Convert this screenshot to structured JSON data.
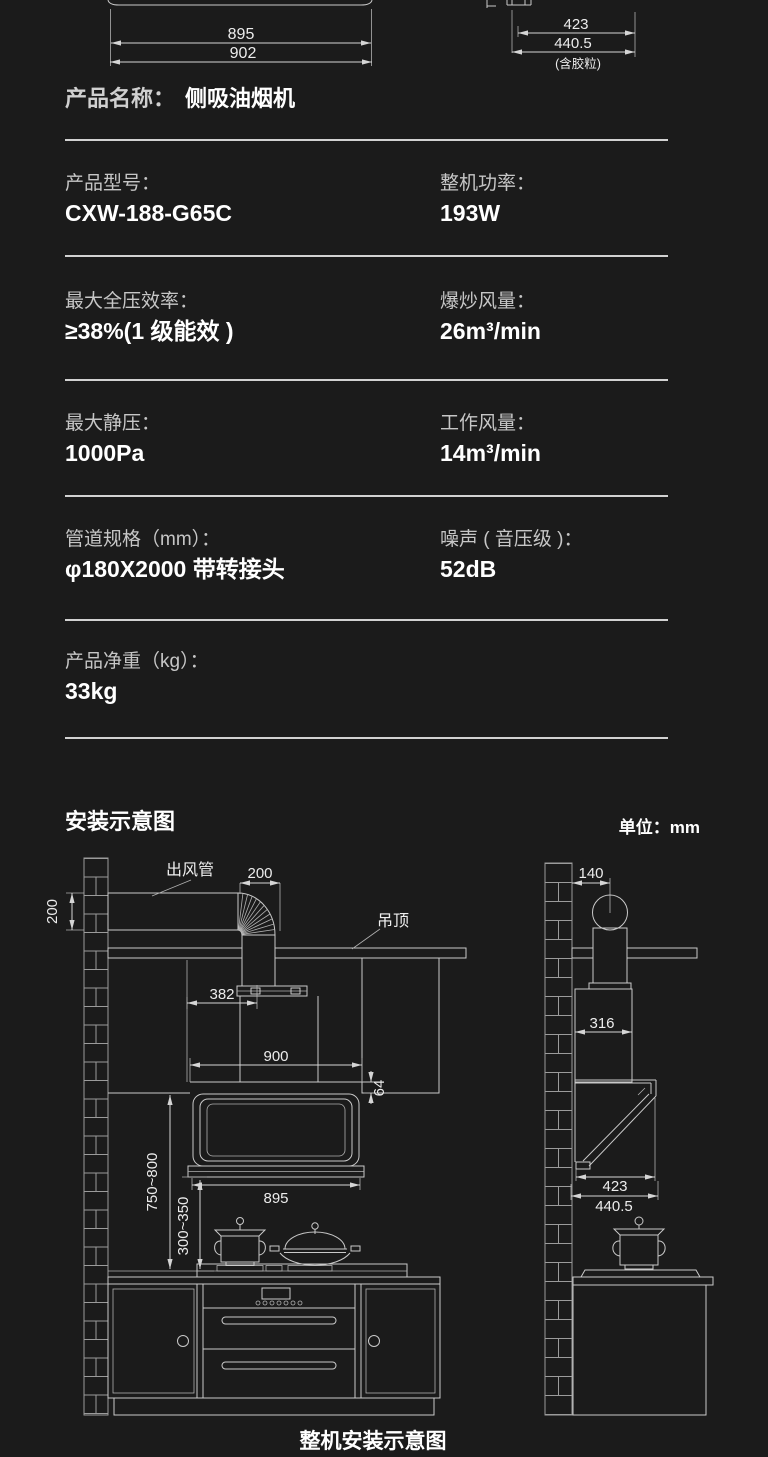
{
  "page": {
    "bg": "#1b1b1b",
    "line_color": "#c9c9c9",
    "divider_color": "#d2d2d2",
    "label_color": "#c6c6c6",
    "value_color": "#ffffff"
  },
  "top_figure": {
    "d895": "895",
    "d902": "902",
    "d423": "423",
    "d4405": "440.5",
    "note": "(含胶粒)"
  },
  "product": {
    "name_label": "产品名称：",
    "name_value": "侧吸油烟机"
  },
  "specs": [
    {
      "left": {
        "label": "产品型号：",
        "value": "CXW-188-G65C"
      },
      "right": {
        "label": "整机功率：",
        "value": "193W"
      }
    },
    {
      "left": {
        "label": "最大全压效率：",
        "value": "≥38%(1 级能效 )"
      },
      "right": {
        "label": "爆炒风量：",
        "value": "26m³/min"
      }
    },
    {
      "left": {
        "label": "最大静压：",
        "value": "1000Pa"
      },
      "right": {
        "label": "工作风量：",
        "value": "14m³/min"
      }
    },
    {
      "left": {
        "label": "管道规格（mm）：",
        "value": "φ180X2000 带转接头"
      },
      "right": {
        "label": "噪声 ( 音压级 )：",
        "value": "52dB"
      }
    },
    {
      "left": {
        "label": "产品净重（kg）：",
        "value": "33kg"
      }
    }
  ],
  "install": {
    "heading": "安装示意图",
    "unit": "单位：mm",
    "caption": "整机安装示意图",
    "front": {
      "duct_label": "出风管",
      "ceiling_label": "吊顶",
      "d200v": "200",
      "d200h": "200",
      "d382": "382",
      "d900": "900",
      "d64": "64",
      "d895": "895",
      "d750": "750~800",
      "d300": "300~350"
    },
    "side": {
      "d140": "140",
      "d316": "316",
      "d423": "423",
      "d4405": "440.5"
    }
  }
}
